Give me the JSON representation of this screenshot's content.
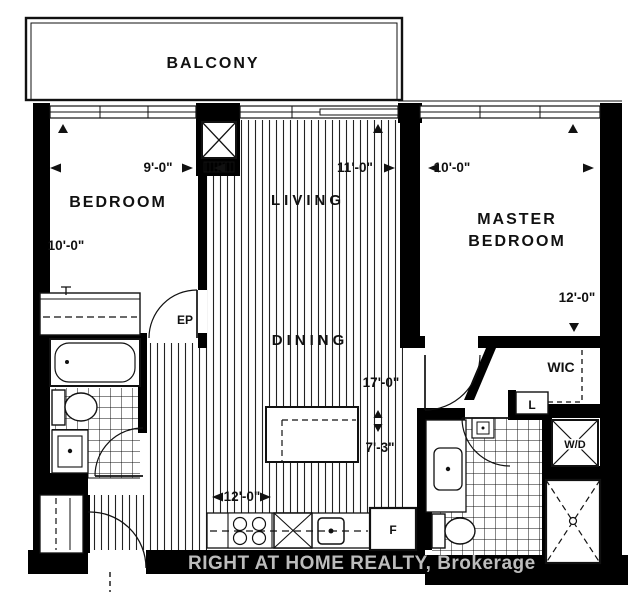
{
  "title": "Condo floor plan",
  "watermark": {
    "text": "RIGHT AT HOME REALTY, Brokerage"
  },
  "labels": {
    "balcony": "BALCONY",
    "bedroom": "BEDROOM",
    "living": "LIVING",
    "dining": "DINING",
    "master_line1": "MASTER",
    "master_line2": "BEDROOM",
    "wic": "WIC",
    "linen": "L",
    "washer_dryer": "W/D",
    "fridge": "F",
    "electrical_panel": "EP"
  },
  "dimensions": {
    "bedroom_width": "9'-0\"",
    "bedroom_depth": "10'-0\"",
    "living_width": "11'-0\"",
    "living_length": "17'-0\"",
    "island_offset": "7'-3\"",
    "kitchen_width": "12'-0\"",
    "master_width": "10'-0\"",
    "master_depth": "12'-0\""
  },
  "colors": {
    "walls": "#000000",
    "lines": "#1a1a1a",
    "watermark": "#cdcdcd",
    "background": "#ffffff"
  }
}
